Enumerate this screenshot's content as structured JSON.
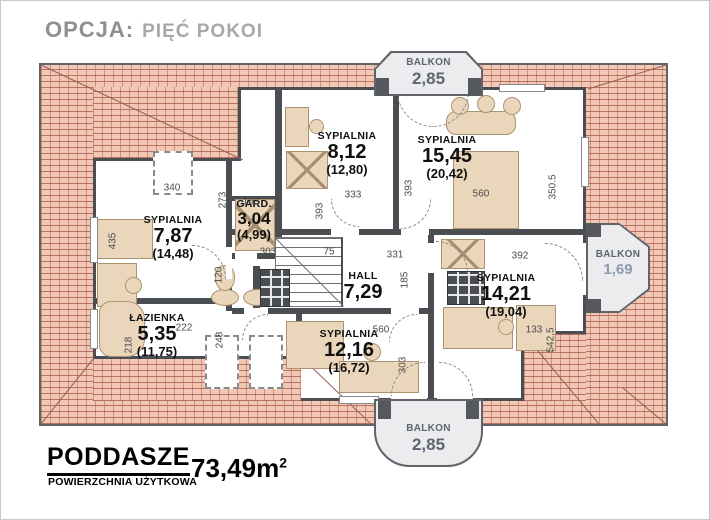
{
  "title": {
    "prefix": "OPCJA:",
    "name": "PIĘĆ POKOI"
  },
  "rooms": [
    {
      "id": "sypialnia-812",
      "name": "SYPIALNIA",
      "area": "8,12",
      "floor_area": "(12,80)"
    },
    {
      "id": "sypialnia-1545",
      "name": "SYPIALNIA",
      "area": "15,45",
      "floor_area": "(20,42)"
    },
    {
      "id": "sypialnia-787",
      "name": "SYPIALNIA",
      "area": "7,87",
      "floor_area": "(14,48)"
    },
    {
      "id": "garderoba",
      "name": "GARD.",
      "area": "3,04",
      "floor_area": "(4,99)"
    },
    {
      "id": "hall",
      "name": "HALL",
      "area": "7,29",
      "floor_area": ""
    },
    {
      "id": "sypialnia-1421",
      "name": "SYPIALNIA",
      "area": "14,21",
      "floor_area": "(19,04)"
    },
    {
      "id": "lazienka",
      "name": "ŁAZIENKA",
      "area": "5,35",
      "floor_area": "(11,75)"
    },
    {
      "id": "sypialnia-1216",
      "name": "SYPIALNIA",
      "area": "12,16",
      "floor_area": "(16,72)"
    }
  ],
  "balconies": [
    {
      "position": "top",
      "name": "BALKON",
      "area": "2,85"
    },
    {
      "position": "right",
      "name": "BALKON",
      "area": "1,69"
    },
    {
      "position": "bottom",
      "name": "BALKON",
      "area": "2,85"
    }
  ],
  "dims": [
    "340",
    "435",
    "273",
    "183",
    "393",
    "393",
    "333",
    "560",
    "350.5",
    "331",
    "185",
    "75",
    "120",
    "303",
    "392",
    "560",
    "303",
    "542,5",
    "133",
    "248",
    "222",
    "218"
  ],
  "footer": {
    "level": "PODDASZE",
    "sublabel": "POWIERZCHNIA UŻYTKOWA",
    "value": "73,49",
    "unit": "m",
    "unit_sup": "2"
  },
  "colors": {
    "roof_tile": "#f2c7b5",
    "roof_line": "#a0503e",
    "wall": "#4a4d52",
    "furniture": "#ead6bb",
    "balcony_fill": "#ececee",
    "label_text": "#101010",
    "dimension_text": "#4c4c4c",
    "title_gray": "#8e9093",
    "balcony_text": "#5d6673"
  }
}
